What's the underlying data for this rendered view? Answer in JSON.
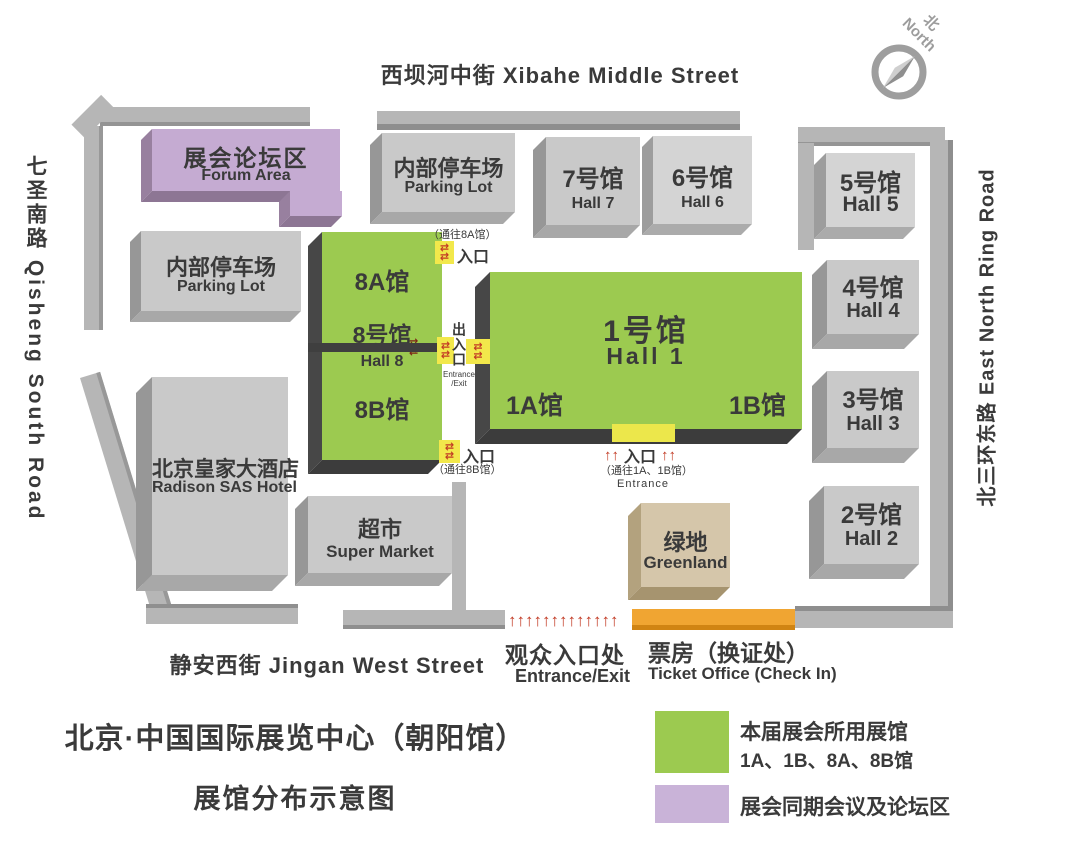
{
  "map_title": {
    "line1": "北京·中国国际展览中心（朝阳馆）",
    "line2": "展馆分布示意图"
  },
  "compass": {
    "zh": "北",
    "en": "North"
  },
  "streets": {
    "top": "西坝河中街 Xibahe Middle Street",
    "left": "七圣南路 Qisheng South Road",
    "right": "北三环东路 East North Ring Road",
    "bottom": "静安西街 Jingan West Street"
  },
  "buildings": {
    "forum": {
      "zh": "展会论坛区",
      "en": "Forum Area"
    },
    "parking_north": {
      "zh": "内部停车场",
      "en": "Parking Lot"
    },
    "parking_west": {
      "zh": "内部停车场",
      "en": "Parking Lot"
    },
    "hall7": {
      "zh": "7号馆",
      "en": "Hall 7"
    },
    "hall6": {
      "zh": "6号馆",
      "en": "Hall 6"
    },
    "hall5": {
      "zh": "5号馆",
      "en": "Hall 5"
    },
    "hall4": {
      "zh": "4号馆",
      "en": "Hall 4"
    },
    "hall3": {
      "zh": "3号馆",
      "en": "Hall 3"
    },
    "hall2": {
      "zh": "2号馆",
      "en": "Hall 2"
    },
    "hall8a": {
      "zh": "8A馆"
    },
    "hall8": {
      "zh": "8号馆",
      "en": "Hall 8"
    },
    "hall8b": {
      "zh": "8B馆"
    },
    "hall1": {
      "zh": "1号馆",
      "en": "Hall 1",
      "wing_a": "1A馆",
      "wing_b": "1B馆"
    },
    "hotel": {
      "zh": "北京皇家大酒店",
      "en": "Radison SAS Hotel"
    },
    "supermarket": {
      "zh": "超市",
      "en": "Super Market"
    },
    "greenland": {
      "zh": "绿地",
      "en": "Greenland"
    }
  },
  "entrances": {
    "gate_8a": {
      "note": "（通往8A馆）",
      "label": "入口",
      "arrows": "⇄"
    },
    "gate_mid": {
      "label": "出入口",
      "en_line1": "Entrance",
      "en_line2": "/Exit",
      "arrows": "⇄"
    },
    "gate_8b": {
      "label": "入口",
      "note": "（通往8B馆）",
      "arrows": "⇄"
    },
    "gate_1": {
      "label": "入口",
      "note": "（通往1A、1B馆）",
      "en": "Entrance",
      "arrows_left": "↑↑",
      "arrows_right": "↑↑"
    },
    "visitor": {
      "zh": "观众入口处",
      "en": "Entrance/Exit",
      "arrows": "↑↑↑↑↑↑↑↑↑↑↑↑↑"
    },
    "ticket": {
      "zh": "票房（换证处）",
      "en": "Ticket Office (Check In)"
    }
  },
  "legend": {
    "used_halls": {
      "line1": "本届展会所用展馆",
      "line2": "1A、1B、8A、8B馆"
    },
    "forum": {
      "label": "展会同期会议及论坛区"
    }
  },
  "colors": {
    "hall_green": "#9cca50",
    "forum_purple": "#c5abd2",
    "legend_purple": "#c9b3d8",
    "building_gray": "#c9c9c9",
    "road_gray": "#b6b6b6",
    "greenland_tan": "#d5c6aa",
    "ticket_orange": "#f0a532",
    "gate_yellow": "#f2e84b",
    "arrow_red": "#c23a24"
  }
}
